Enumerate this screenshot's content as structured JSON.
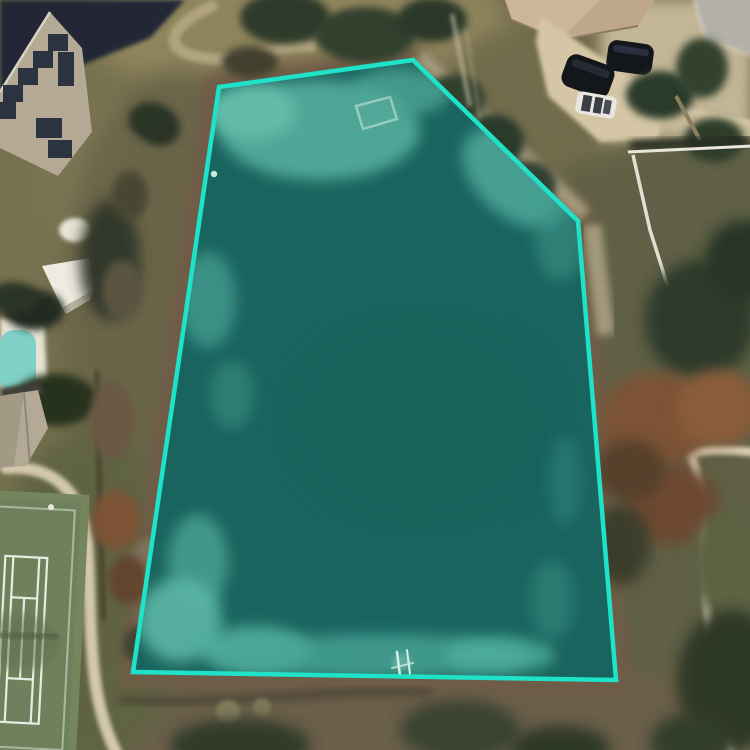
{
  "view": {
    "kind": "satellite-aerial-map",
    "description": "Aerial imagery of a residential neighborhood with a highlighted pond parcel outlined in cyan"
  },
  "parcel": {
    "shape": "polygon",
    "vertices": [
      [
        219,
        87
      ],
      [
        413,
        60
      ],
      [
        578,
        221
      ],
      [
        616,
        680
      ],
      [
        133,
        672
      ]
    ],
    "points_str": "219,87 413,60 578,221 616,680 133,672",
    "shore_points_str": "205,73 419,45 592,210 631,694 118,686",
    "stroke_color": "#1fe3c8",
    "fill_color": "rgba(32,227,200,0.12)",
    "stroke_width": "4.5"
  },
  "colors": {
    "water_deep": "#1a5351",
    "water_shallow": "#5fae9f",
    "grass": "#6e6a4b",
    "dirt_shore": "#6f5c46",
    "path": "#d3c8ac",
    "court_green": "#6f815c",
    "court_line": "#e9ece2",
    "pool_water": "#7fd0c7",
    "deck_white": "#e7e3d4",
    "roof_gray": "#b3a995",
    "roof_tan": "#ccb599",
    "solar_panel": "#2b3240",
    "driveway": "#d5c7a5",
    "car_dark": "#13161b",
    "car_white": "#e9e7e0",
    "fence_white": "#eae6da",
    "tree_dark": "#2e3b2a",
    "tree_rust": "#7c5336"
  },
  "features": {
    "water_body": "pond",
    "landmarks": [
      "house-with-solar-panels",
      "gazebo",
      "swimming-pool",
      "hip-roof-house",
      "tennis-court",
      "house-with-driveway",
      "parked-cars",
      "white-fence",
      "walking-paths",
      "small-dock",
      "sunken-platform"
    ]
  }
}
